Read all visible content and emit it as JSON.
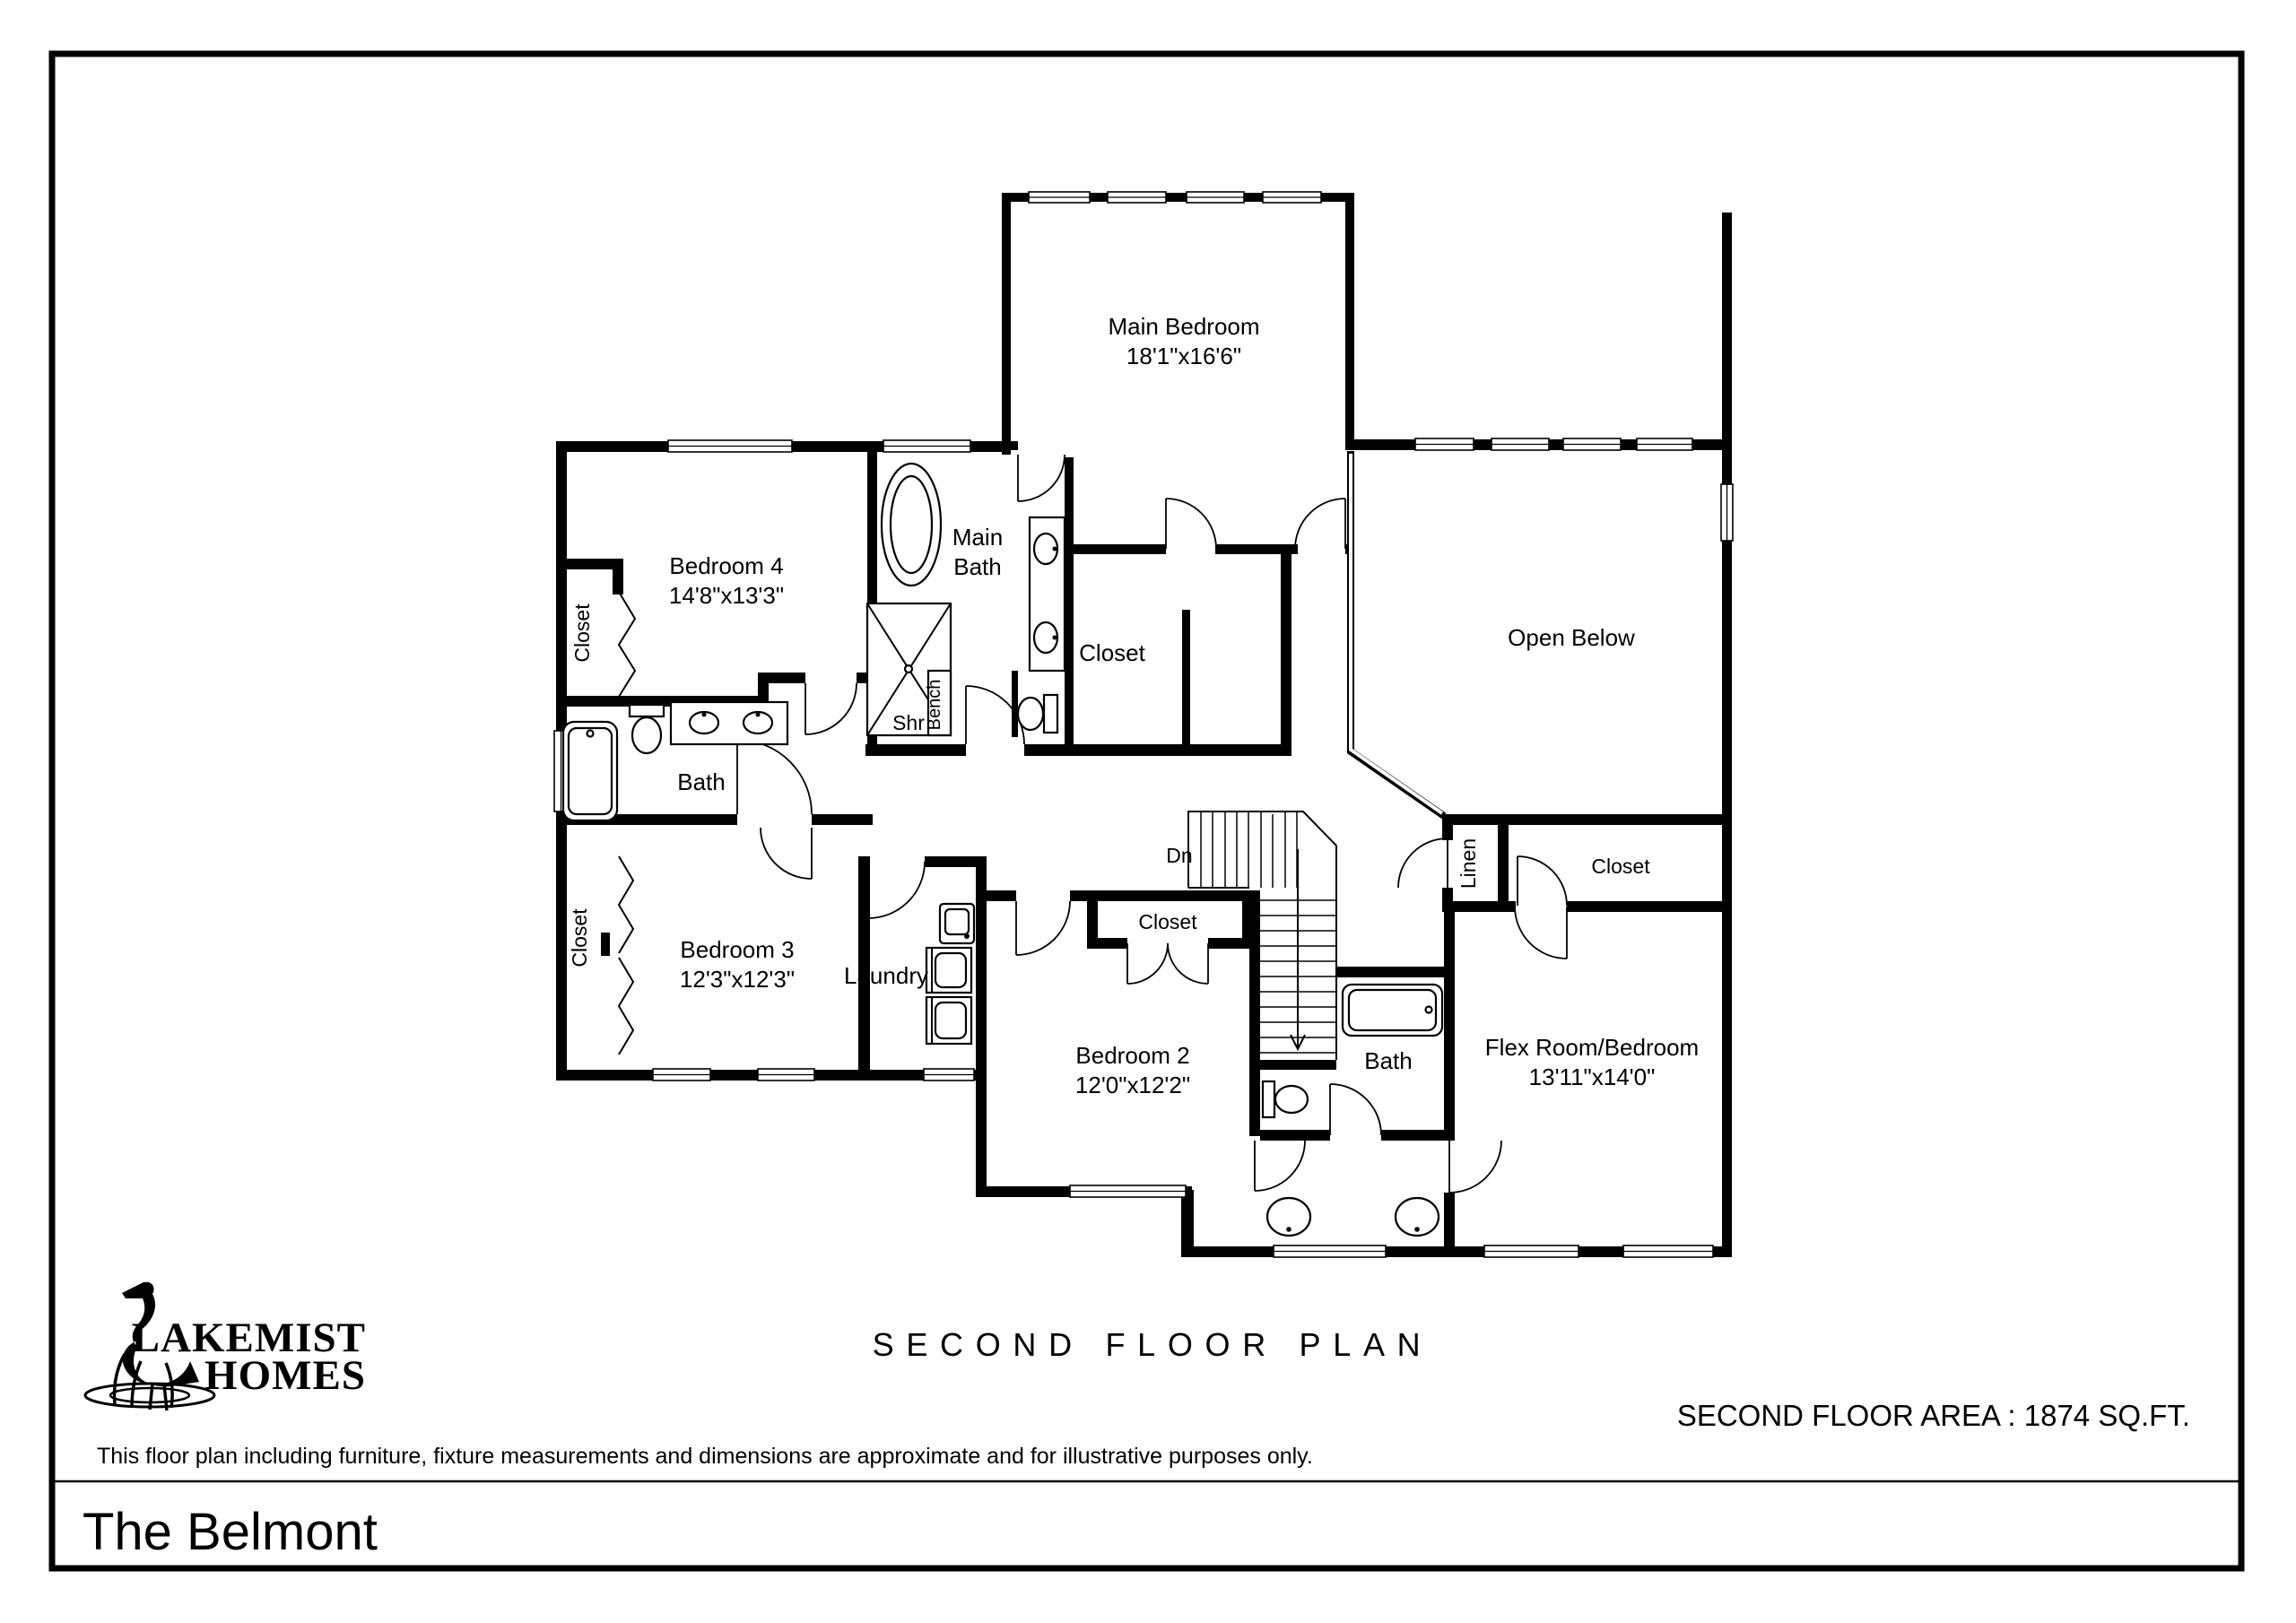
{
  "sheet": {
    "plan_title": "SECOND FLOOR PLAN",
    "area_text": "SECOND FLOOR AREA : 1874 SQ.FT.",
    "disclaimer": "This floor plan including furniture, fixture measurements and dimensions are approximate and for illustrative purposes only.",
    "model_name": "The Belmont"
  },
  "logo": {
    "brand_line1": "LAKEMIST",
    "brand_line2": "HOMES",
    "icon": "heron-in-water-icon"
  },
  "rooms": {
    "main_bedroom": {
      "name": "Main Bedroom",
      "dims": "18'1\"x16'6\""
    },
    "bedroom4": {
      "name": "Bedroom 4",
      "dims": "14'8\"x13'3\""
    },
    "main_bath": {
      "line1": "Main",
      "line2": "Bath"
    },
    "main_closet": {
      "name": "Closet"
    },
    "open_below": {
      "name": "Open Below"
    },
    "bath_left": {
      "name": "Bath"
    },
    "bedroom4_closet": {
      "name": "Closet"
    },
    "bedroom3": {
      "name": "Bedroom 3",
      "dims": "12'3\"x12'3\""
    },
    "bedroom3_closet": {
      "name": "Closet"
    },
    "laundry": {
      "name": "Laundry"
    },
    "bedroom2_closet": {
      "name": "Closet"
    },
    "bedroom2": {
      "name": "Bedroom 2",
      "dims": "12'0\"x12'2\""
    },
    "linen": {
      "name": "Linen"
    },
    "flex_closet": {
      "name": "Closet"
    },
    "bath_center": {
      "name": "Bath"
    },
    "flex_room": {
      "name": "Flex Room/Bedroom",
      "dims": "13'11\"x14'0\""
    }
  },
  "annotations": {
    "stairs_down": "Dn",
    "shower": "Shr",
    "bench": "Bench"
  },
  "colors": {
    "ink": "#000000",
    "paper": "#ffffff"
  }
}
